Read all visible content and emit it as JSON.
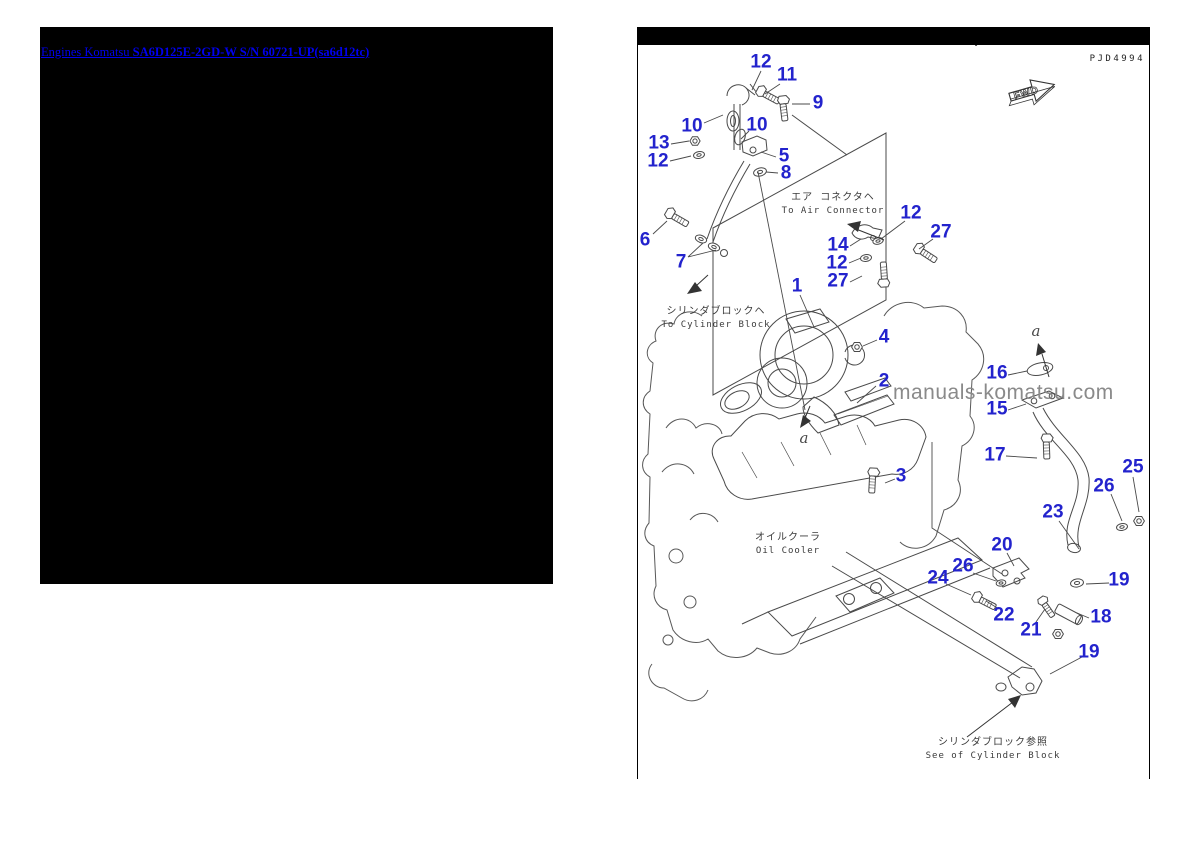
{
  "colors": {
    "callout": "#2323cd",
    "link": "#0000ee",
    "line": "#4a4a4a",
    "watermark": "#8a8a8a"
  },
  "breadcrumb_link": {
    "prefix": "Engines Komatsu ",
    "model": "SA6D125E-2GD-W S/N 60721-UP(sa6d12tc)"
  },
  "diagram": {
    "doc_id": "PJD4994",
    "top_cropped_caption": "See of Cylinder Block",
    "fwd_arrow_label": "FWD",
    "watermark_text": "manuals-komatsu.com",
    "annotations": [
      {
        "jp": "エア コネクタヘ",
        "en": "To Air Connector",
        "x": 833,
        "y": 191
      },
      {
        "jp": "シリンダブロックヘ",
        "en": "To Cylinder Block",
        "x": 716,
        "y": 305
      },
      {
        "jp": "オイルクーラ",
        "en": "Oil Cooler",
        "x": 788,
        "y": 531
      },
      {
        "jp": "シリンダブロック参照",
        "en": "See of Cylinder Block",
        "x": 993,
        "y": 736
      }
    ],
    "view_refs": [
      {
        "label": "a",
        "x": 804,
        "y": 429
      },
      {
        "label": "a",
        "x": 1036,
        "y": 322
      }
    ],
    "callouts": [
      {
        "n": "12",
        "x": 761,
        "y": 62
      },
      {
        "n": "11",
        "x": 787,
        "y": 75
      },
      {
        "n": "9",
        "x": 818,
        "y": 103
      },
      {
        "n": "10",
        "x": 692,
        "y": 126
      },
      {
        "n": "10",
        "x": 757,
        "y": 125
      },
      {
        "n": "13",
        "x": 659,
        "y": 143
      },
      {
        "n": "12",
        "x": 658,
        "y": 161
      },
      {
        "n": "5",
        "x": 784,
        "y": 156
      },
      {
        "n": "8",
        "x": 786,
        "y": 173
      },
      {
        "n": "6",
        "x": 645,
        "y": 240
      },
      {
        "n": "7",
        "x": 681,
        "y": 262
      },
      {
        "n": "12",
        "x": 911,
        "y": 213
      },
      {
        "n": "27",
        "x": 941,
        "y": 232
      },
      {
        "n": "14",
        "x": 838,
        "y": 245
      },
      {
        "n": "12",
        "x": 837,
        "y": 263
      },
      {
        "n": "27",
        "x": 838,
        "y": 281
      },
      {
        "n": "1",
        "x": 797,
        "y": 286
      },
      {
        "n": "4",
        "x": 884,
        "y": 337
      },
      {
        "n": "2",
        "x": 884,
        "y": 381
      },
      {
        "n": "16",
        "x": 997,
        "y": 373
      },
      {
        "n": "15",
        "x": 997,
        "y": 409
      },
      {
        "n": "17",
        "x": 995,
        "y": 455
      },
      {
        "n": "3",
        "x": 901,
        "y": 476
      },
      {
        "n": "25",
        "x": 1133,
        "y": 467
      },
      {
        "n": "26",
        "x": 1104,
        "y": 486
      },
      {
        "n": "23",
        "x": 1053,
        "y": 512
      },
      {
        "n": "20",
        "x": 1002,
        "y": 545
      },
      {
        "n": "26",
        "x": 963,
        "y": 566
      },
      {
        "n": "24",
        "x": 938,
        "y": 578
      },
      {
        "n": "19",
        "x": 1119,
        "y": 580
      },
      {
        "n": "22",
        "x": 1004,
        "y": 615
      },
      {
        "n": "21",
        "x": 1031,
        "y": 630
      },
      {
        "n": "18",
        "x": 1101,
        "y": 617
      },
      {
        "n": "19",
        "x": 1089,
        "y": 652
      }
    ]
  }
}
